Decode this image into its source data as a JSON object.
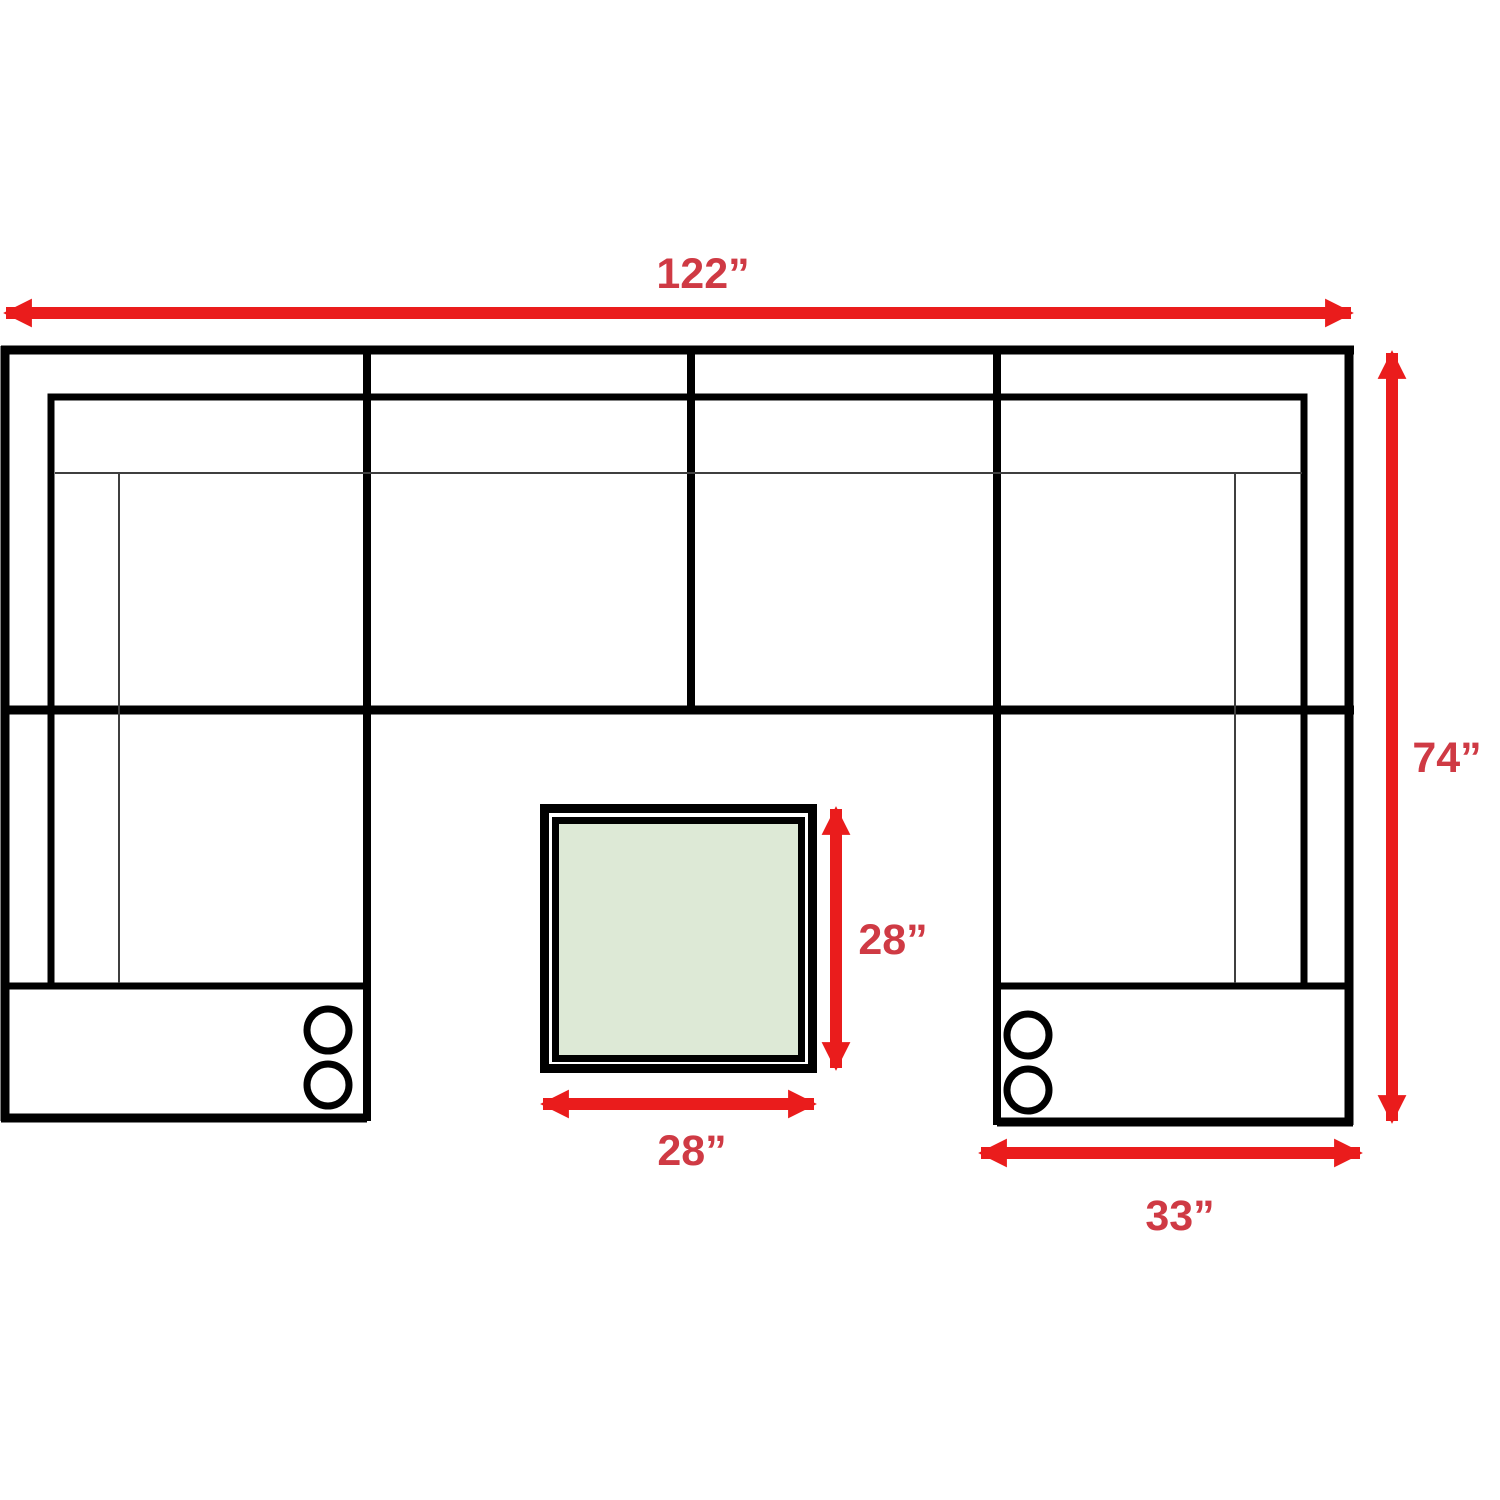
{
  "diagram": {
    "title": "U-shaped sectional sofa with ottoman - dimension plan",
    "labels": {
      "overall_width": "122”",
      "overall_depth": "74”",
      "ottoman_depth": "28”",
      "ottoman_width": "28”",
      "console_width": "33”"
    },
    "dimensions_inches": {
      "overall_width": 122,
      "overall_depth": 74,
      "ottoman_depth": 28,
      "ottoman_width": 28,
      "console_width": 33
    },
    "features": {
      "cupholders_left_console": 2,
      "cupholders_right_console": 2
    }
  },
  "colors": {
    "arrow": "#ea1c1c",
    "label": "#cf3a44",
    "outline": "#000000",
    "thin_line": "#3f3f3f",
    "ottoman_fill": "#dde9d6",
    "background": "#ffffff"
  }
}
